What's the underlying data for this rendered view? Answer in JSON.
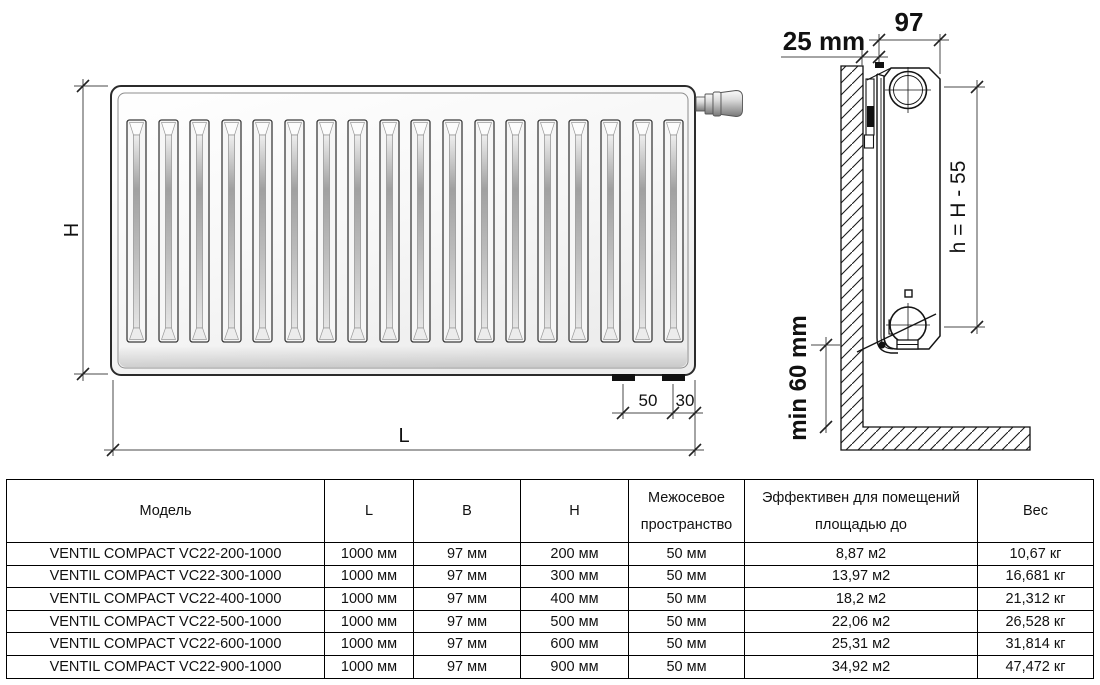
{
  "drawing": {
    "front_labels": {
      "h": "H",
      "l": "L",
      "d50": "50",
      "d30": "30"
    },
    "side_labels": {
      "depth": "97",
      "wall_gap": "25 mm",
      "axis_height": "h = H - 55",
      "floor_gap": "min 60 mm"
    }
  },
  "table": {
    "headers": {
      "model": "Модель",
      "l": "L",
      "b": "B",
      "h": "H",
      "spacing1": "Межосевое",
      "spacing2": "пространство",
      "area1": "Эффективен для помещений",
      "area2": "площадью до",
      "weight": "Вес"
    },
    "rows": [
      {
        "model": "VENTIL COMPACT VC22-200-1000",
        "l": "1000 мм",
        "b": "97 мм",
        "h": "200 мм",
        "spacing": "50 мм",
        "area": "8,87 м2",
        "weight": "10,67 кг"
      },
      {
        "model": "VENTIL COMPACT VC22-300-1000",
        "l": "1000 мм",
        "b": "97 мм",
        "h": "300 мм",
        "spacing": "50 мм",
        "area": "13,97 м2",
        "weight": "16,681 кг"
      },
      {
        "model": "VENTIL COMPACT VC22-400-1000",
        "l": "1000 мм",
        "b": "97 мм",
        "h": "400 мм",
        "spacing": "50 мм",
        "area": "18,2 м2",
        "weight": "21,312 кг"
      },
      {
        "model": "VENTIL COMPACT VC22-500-1000",
        "l": "1000 мм",
        "b": "97 мм",
        "h": "500 мм",
        "spacing": "50 мм",
        "area": "22,06 м2",
        "weight": "26,528 кг"
      },
      {
        "model": "VENTIL COMPACT VC22-600-1000",
        "l": "1000 мм",
        "b": "97 мм",
        "h": "600 мм",
        "spacing": "50 мм",
        "area": "25,31 м2",
        "weight": "31,814 кг"
      },
      {
        "model": "VENTIL COMPACT VC22-900-1000",
        "l": "1000 мм",
        "b": "97 мм",
        "h": "900 мм",
        "spacing": "50 мм",
        "area": "34,92 м2",
        "weight": "47,472 кг"
      }
    ]
  },
  "colors": {
    "line": "#141414",
    "dim_line": "#4a4a4a",
    "text": "#111111"
  }
}
